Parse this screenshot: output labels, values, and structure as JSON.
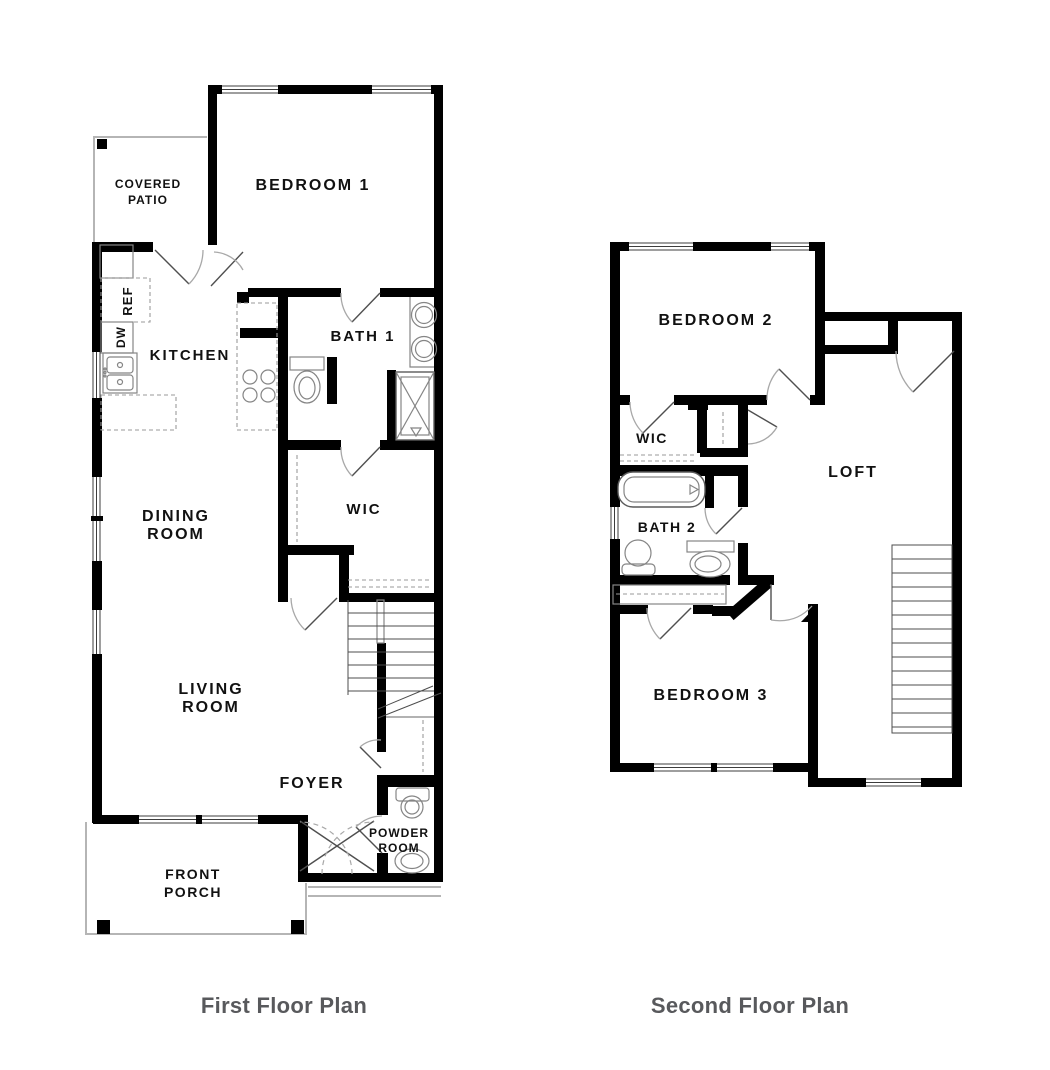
{
  "colors": {
    "wall": "#000000",
    "label": "#111111",
    "caption": "#58595c",
    "fixture": "#858585",
    "door": "#a8a8a8",
    "outline": "#b5b5b5"
  },
  "first_floor": {
    "caption": "First Floor Plan",
    "labels": {
      "covered_patio": {
        "l1": "COVERED",
        "l2": "PATIO"
      },
      "bedroom1": {
        "l1": "BEDROOM 1"
      },
      "kitchen": {
        "l1": "KITCHEN"
      },
      "ref": {
        "l1": "REF"
      },
      "dw": {
        "l1": "DW"
      },
      "bath1": {
        "l1": "BATH 1"
      },
      "wic": {
        "l1": "WIC"
      },
      "dining": {
        "l1": "DINING",
        "l2": "ROOM"
      },
      "living": {
        "l1": "LIVING",
        "l2": "ROOM"
      },
      "foyer": {
        "l1": "FOYER"
      },
      "powder": {
        "l1": "POWDER",
        "l2": "ROOM"
      },
      "porch": {
        "l1": "FRONT",
        "l2": "PORCH"
      }
    }
  },
  "second_floor": {
    "caption": "Second Floor Plan",
    "labels": {
      "bedroom2": {
        "l1": "BEDROOM 2"
      },
      "wic": {
        "l1": "WIC"
      },
      "bath2": {
        "l1": "BATH 2"
      },
      "loft": {
        "l1": "LOFT"
      },
      "bedroom3": {
        "l1": "BEDROOM 3"
      }
    }
  }
}
